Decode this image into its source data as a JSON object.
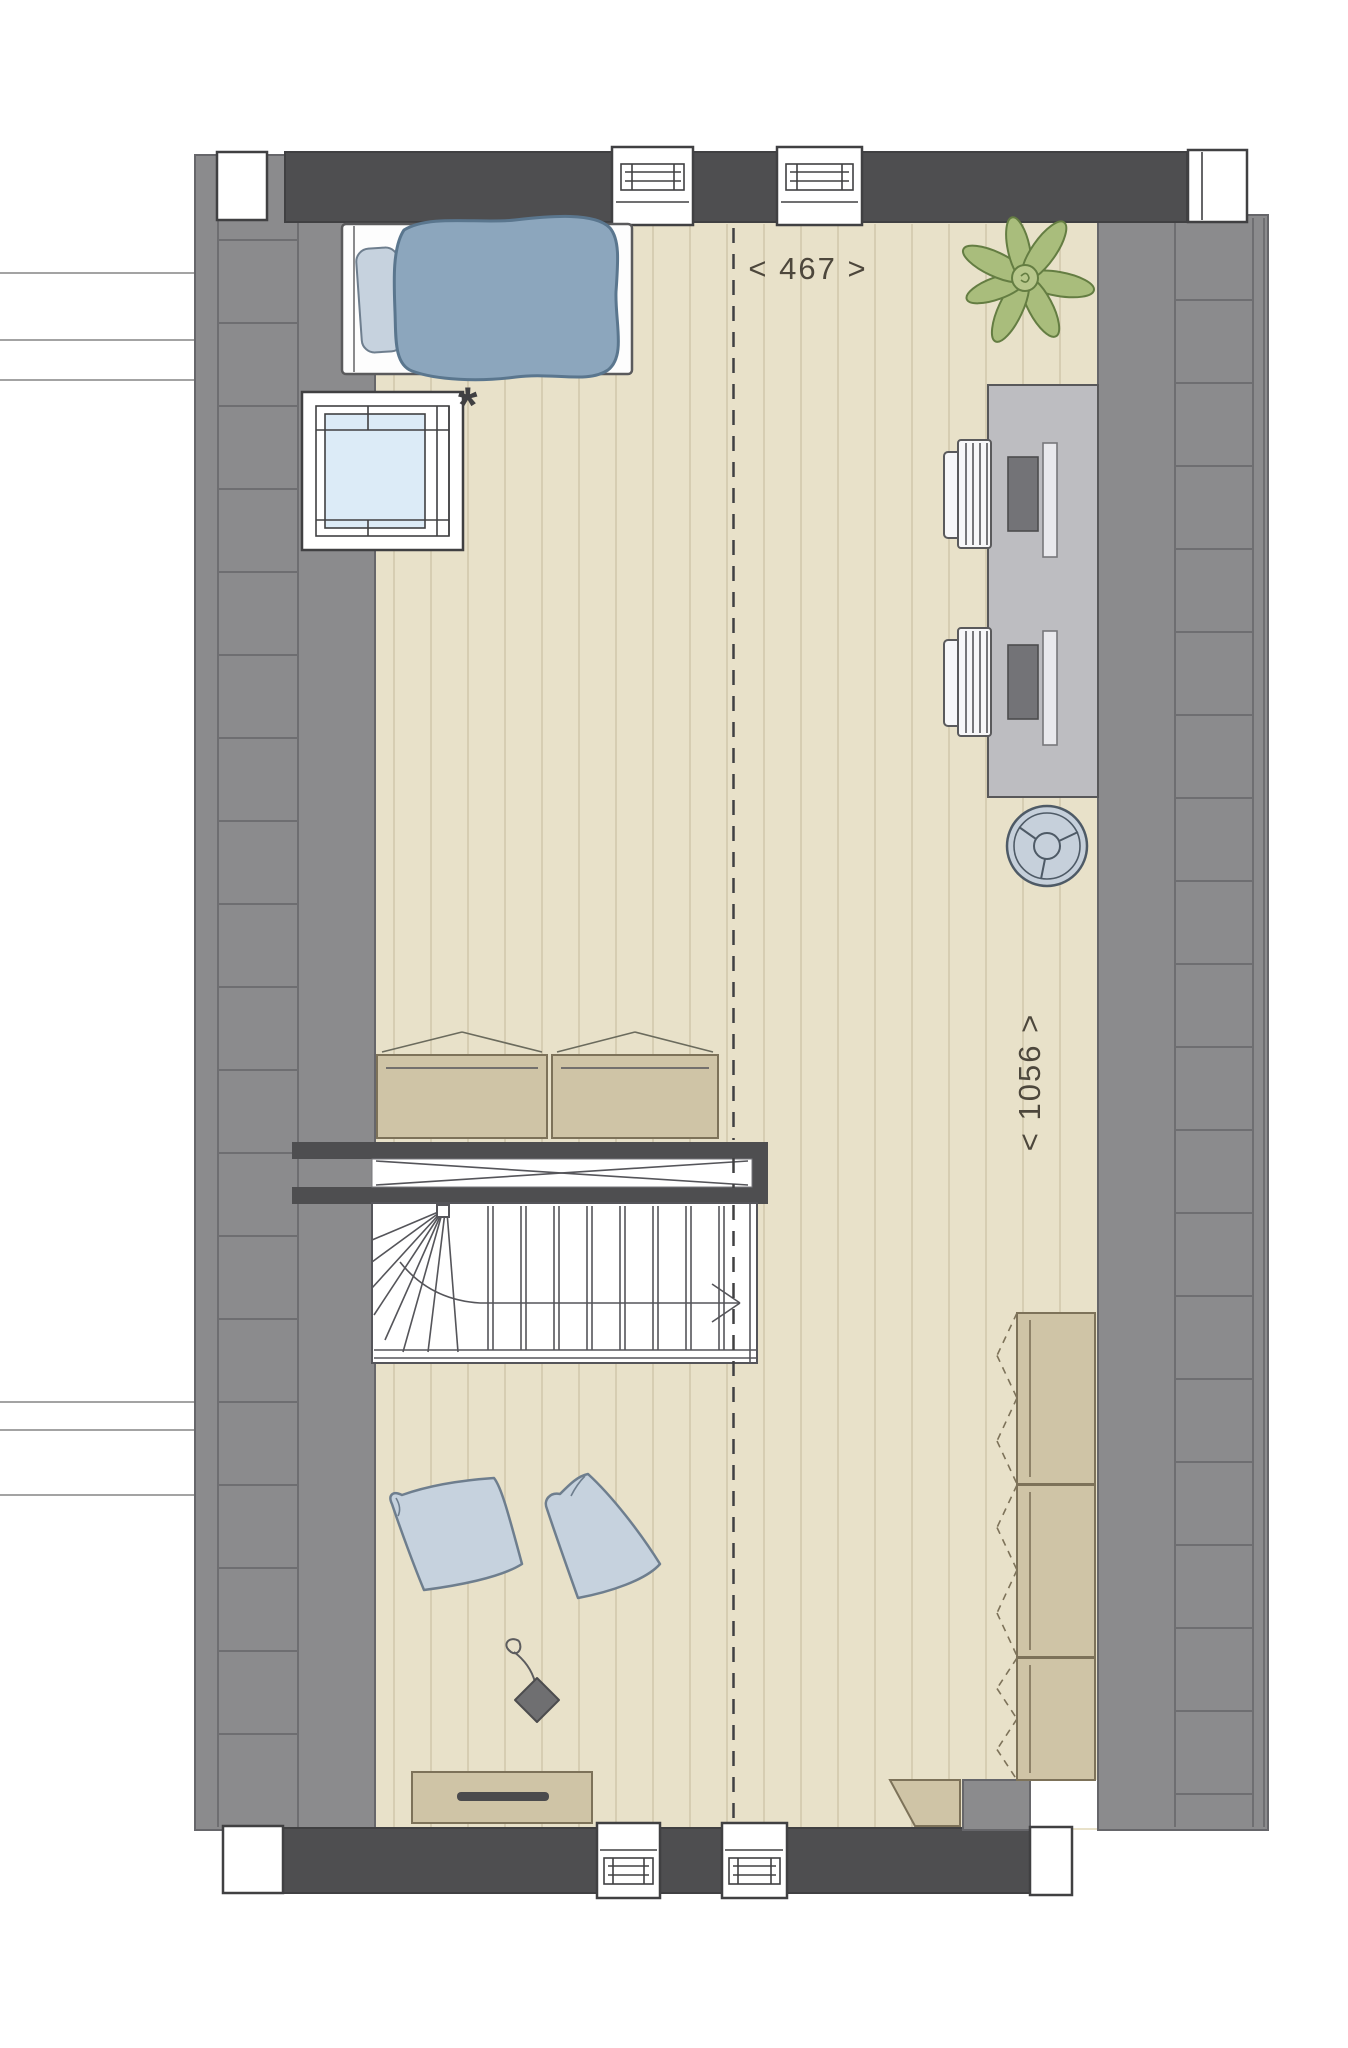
{
  "annotations": {
    "width_label": "< 467 >",
    "depth_label": "< 1056 >",
    "window_marker": "*"
  },
  "colors": {
    "wall_dark": "#4e4e50",
    "wall_gray": "#8b8b8d",
    "wall_line": "#6e6e71",
    "wall_edge": "#66666a",
    "outline": "#404042",
    "floor": "#e8e1c9",
    "plank_line": "#d6cdb2",
    "glass": "#dcebf7",
    "duvet": "#8ca6bd",
    "duvet_line": "#5a768e",
    "pillow_blue": "#c6d2de",
    "pillow_line": "#6e7e8e",
    "plant_green": "#a9bd7c",
    "plant_dark": "#647d42",
    "desk_gray": "#bdbdc1",
    "laptop_gray": "#737377",
    "chair_white": "#f7f7f9",
    "fan_fill": "#c6d0db",
    "fan_line": "#4e5a66",
    "tan": "#cfc4a6",
    "tan_line": "#7d7259",
    "handle_dark": "#4b4b4d",
    "stair_line": "#55555a",
    "cord_gray": "#6f6f71",
    "text_color": "#4d473c"
  }
}
